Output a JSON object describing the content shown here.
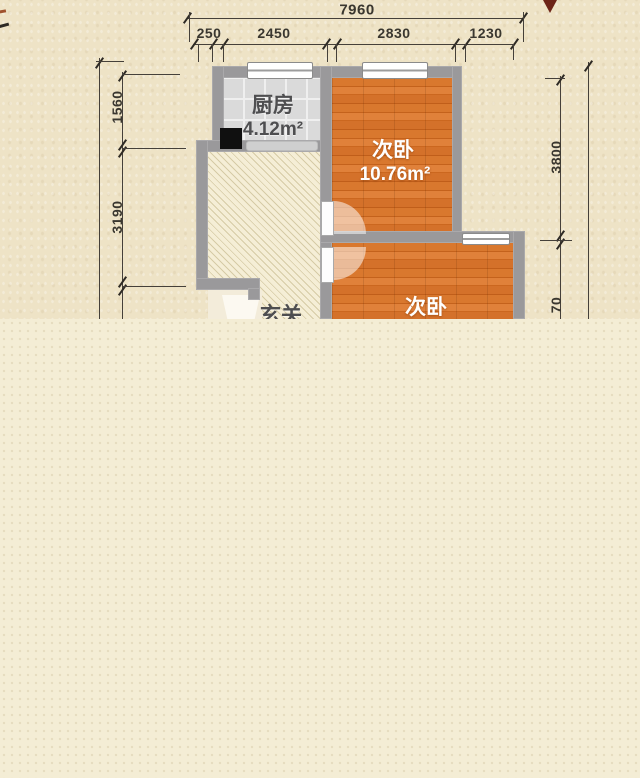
{
  "floorplan": {
    "rooms": {
      "kitchen": {
        "name": "厨房",
        "area": "4.12m²"
      },
      "bedroom_top": {
        "name": "次卧",
        "area": "10.76m²"
      },
      "bedroom_bottom": {
        "name": "次卧"
      },
      "hall": {
        "name": "玄关"
      }
    },
    "dimensions": {
      "top_total": "7960",
      "top_segments": [
        "250",
        "2450",
        "2830",
        "1230"
      ],
      "left_segments": [
        "1560",
        "3190"
      ],
      "right_segments": [
        "3800",
        "70"
      ]
    },
    "colors": {
      "background": "#eee3c6",
      "background_bottom": "#f4edd5",
      "dot_color": "#e6dcbf",
      "wall": "#9a999b",
      "wood_floor": "#d4712a",
      "kitchen_floor": "#dadada",
      "hall_floor": "#f5eed6",
      "dimension_text": "#3a372f",
      "room_label_light": "#ffffff",
      "room_label_dark": "#4e4e50"
    }
  }
}
